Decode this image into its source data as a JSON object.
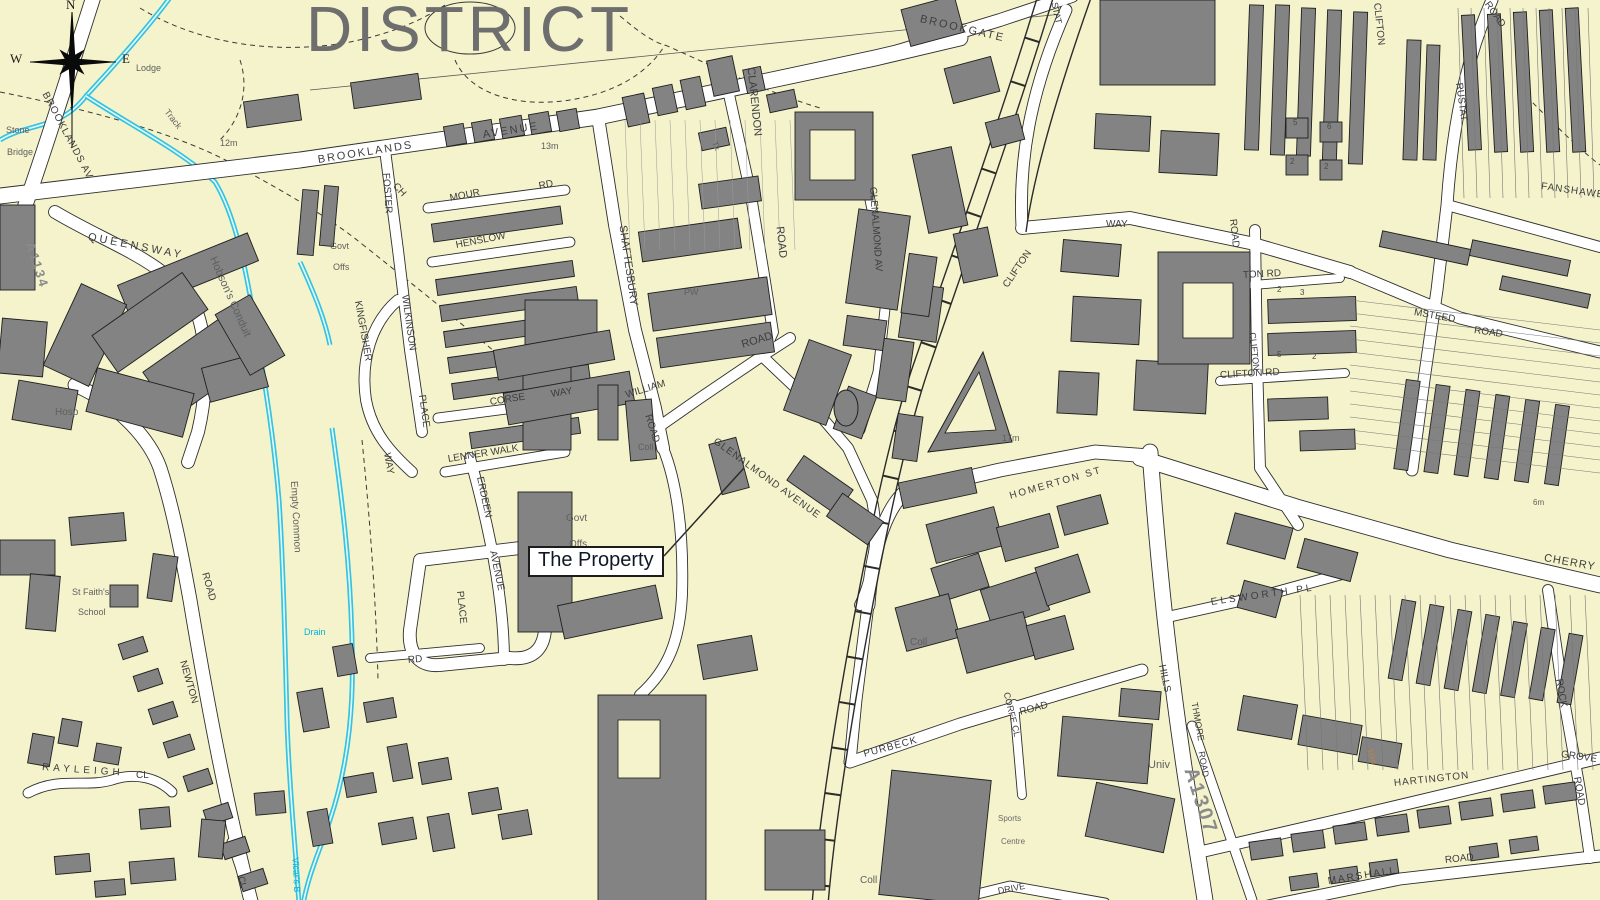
{
  "title": {
    "text": "DISTRICT"
  },
  "callout": {
    "text": "The Property"
  },
  "compass": {
    "north": "N",
    "west": "W",
    "east": "E"
  },
  "colors": {
    "background": "#f4f3cb",
    "building": "#838383",
    "road_fill": "#ffffff",
    "road_casing": "#2e2e2e",
    "water": "#35c3e0",
    "water_label": "#00b3d6",
    "contour_label": "#c08448",
    "title_gray": "#6e6e6e"
  },
  "map": {
    "labels": [
      {
        "t": "BROOKLANDS",
        "x": 318,
        "y": 155,
        "r": -9,
        "s": 11,
        "c": "road",
        "ls": 2
      },
      {
        "t": "AVENUE",
        "x": 483,
        "y": 130,
        "r": -9,
        "s": 11,
        "c": "road",
        "ls": 2
      },
      {
        "t": "BROOKLANDS AV",
        "x": 44,
        "y": 88,
        "r": 62,
        "s": 10,
        "c": "road",
        "ls": 1
      },
      {
        "t": "Stone",
        "x": 6,
        "y": 126,
        "r": 0,
        "s": 9,
        "c": "area"
      },
      {
        "t": "Bridge",
        "x": 7,
        "y": 148,
        "r": 0,
        "s": 9,
        "c": "area"
      },
      {
        "t": "Lodge",
        "x": 136,
        "y": 64,
        "r": 0,
        "s": 9,
        "c": "area"
      },
      {
        "t": "Track",
        "x": 166,
        "y": 106,
        "r": 52,
        "s": 9,
        "c": "area"
      },
      {
        "t": "12m",
        "x": 220,
        "y": 139,
        "r": 0,
        "s": 9,
        "c": "area"
      },
      {
        "t": "13m",
        "x": 541,
        "y": 142,
        "r": 0,
        "s": 9,
        "c": "area"
      },
      {
        "t": "Tk",
        "x": 714,
        "y": 138,
        "r": 70,
        "s": 8,
        "c": "area"
      },
      {
        "t": "QUEENSWAY",
        "x": 88,
        "y": 232,
        "r": 11,
        "s": 11,
        "c": "road",
        "ls": 3
      },
      {
        "t": "A1134",
        "x": 30,
        "y": 236,
        "r": 72,
        "s": 13,
        "c": "anum"
      },
      {
        "t": "Hobson's Conduit",
        "x": 212,
        "y": 252,
        "r": 66,
        "s": 11,
        "c": "area"
      },
      {
        "t": "Govt",
        "x": 330,
        "y": 242,
        "r": 0,
        "s": 9,
        "c": "area"
      },
      {
        "t": "Offs",
        "x": 333,
        "y": 263,
        "r": 0,
        "s": 9,
        "c": "area"
      },
      {
        "t": "FOSTER",
        "x": 385,
        "y": 168,
        "r": 86,
        "s": 10,
        "c": "road"
      },
      {
        "t": "CH",
        "x": 394,
        "y": 180,
        "r": 48,
        "s": 10,
        "c": "road"
      },
      {
        "t": "MOUR",
        "x": 450,
        "y": 194,
        "r": -11,
        "s": 10,
        "c": "road"
      },
      {
        "t": "RD",
        "x": 539,
        "y": 182,
        "r": -11,
        "s": 10,
        "c": "road"
      },
      {
        "t": "HENSLOW",
        "x": 456,
        "y": 241,
        "r": -11,
        "s": 10,
        "c": "road"
      },
      {
        "t": "KINGFISHER",
        "x": 357,
        "y": 296,
        "r": 80,
        "s": 10,
        "c": "road"
      },
      {
        "t": "WAY",
        "x": 386,
        "y": 448,
        "r": 80,
        "s": 10,
        "c": "road"
      },
      {
        "t": "WILKINSON",
        "x": 404,
        "y": 290,
        "r": 82,
        "s": 10,
        "c": "road"
      },
      {
        "t": "PLACE",
        "x": 421,
        "y": 390,
        "r": 82,
        "s": 10,
        "c": "road"
      },
      {
        "t": "CORSE",
        "x": 490,
        "y": 398,
        "r": -9,
        "s": 10,
        "c": "road"
      },
      {
        "t": "WAY",
        "x": 551,
        "y": 390,
        "r": -9,
        "s": 10,
        "c": "road"
      },
      {
        "t": "LENNER WALK",
        "x": 448,
        "y": 455,
        "r": -9,
        "s": 10,
        "c": "road"
      },
      {
        "t": "ERDEEN",
        "x": 479,
        "y": 472,
        "r": 78,
        "s": 10,
        "c": "road"
      },
      {
        "t": "AVENUE",
        "x": 492,
        "y": 546,
        "r": 78,
        "s": 10,
        "c": "road"
      },
      {
        "t": "PLACE",
        "x": 459,
        "y": 586,
        "r": 84,
        "s": 10,
        "c": "road"
      },
      {
        "t": "RD",
        "x": 408,
        "y": 656,
        "r": -5,
        "s": 10,
        "c": "road"
      },
      {
        "t": "SHAFTESBURY",
        "x": 622,
        "y": 220,
        "r": 82,
        "s": 11,
        "c": "road"
      },
      {
        "t": "CLARENDON",
        "x": 750,
        "y": 62,
        "r": 84,
        "s": 11,
        "c": "road"
      },
      {
        "t": "ROAD",
        "x": 779,
        "y": 221,
        "r": 84,
        "s": 11,
        "c": "road"
      },
      {
        "t": "PW",
        "x": 684,
        "y": 288,
        "r": 0,
        "s": 9,
        "c": "area"
      },
      {
        "t": "Coll",
        "x": 638,
        "y": 443,
        "r": 0,
        "s": 9,
        "c": "area"
      },
      {
        "t": "WILLIAM",
        "x": 626,
        "y": 391,
        "r": -17,
        "s": 10,
        "c": "road"
      },
      {
        "t": "ROAD",
        "x": 647,
        "y": 410,
        "r": 72,
        "s": 10,
        "c": "road"
      },
      {
        "t": "ROAD",
        "x": 742,
        "y": 340,
        "r": -17,
        "s": 11,
        "c": "road"
      },
      {
        "t": "GLENALMOND AV",
        "x": 872,
        "y": 182,
        "r": 86,
        "s": 10,
        "c": "road"
      },
      {
        "t": "GLENALMOND AVENUE",
        "x": 714,
        "y": 436,
        "r": 36,
        "s": 10,
        "c": "road",
        "ls": 1
      },
      {
        "t": "Govt",
        "x": 566,
        "y": 514,
        "r": 0,
        "s": 10,
        "c": "area"
      },
      {
        "t": "Offs",
        "x": 569,
        "y": 540,
        "r": 0,
        "s": 10,
        "c": "area"
      },
      {
        "t": "BROOKGATE",
        "x": 920,
        "y": 14,
        "r": 13,
        "s": 11,
        "c": "road",
        "ls": 2
      },
      {
        "t": "STAT",
        "x": 1054,
        "y": -2,
        "r": 78,
        "s": 9,
        "c": "road"
      },
      {
        "t": "CLIFTON",
        "x": 1006,
        "y": 282,
        "r": -56,
        "s": 10,
        "c": "road"
      },
      {
        "t": "WAY",
        "x": 1106,
        "y": 220,
        "r": 0,
        "s": 10,
        "c": "road"
      },
      {
        "t": "17m",
        "x": 1002,
        "y": 434,
        "r": 0,
        "s": 9,
        "c": "area"
      },
      {
        "t": "HOMERTON ST",
        "x": 1010,
        "y": 492,
        "r": -16,
        "s": 10,
        "c": "road",
        "ls": 2
      },
      {
        "t": "Coll",
        "x": 910,
        "y": 638,
        "r": 0,
        "s": 10,
        "c": "area"
      },
      {
        "t": "Coll",
        "x": 860,
        "y": 876,
        "r": 0,
        "s": 10,
        "c": "area"
      },
      {
        "t": "PURBECK",
        "x": 864,
        "y": 750,
        "r": -15,
        "s": 10,
        "c": "road",
        "ls": 1
      },
      {
        "t": "ROAD",
        "x": 1020,
        "y": 708,
        "r": -15,
        "s": 10,
        "c": "road"
      },
      {
        "t": "CORFE CL",
        "x": 1006,
        "y": 688,
        "r": 76,
        "s": 9,
        "c": "road"
      },
      {
        "t": "Sports",
        "x": 998,
        "y": 815,
        "r": 0,
        "s": 8,
        "c": "tiny"
      },
      {
        "t": "Centre",
        "x": 1001,
        "y": 838,
        "r": 0,
        "s": 8,
        "c": "tiny"
      },
      {
        "t": "Univ",
        "x": 1148,
        "y": 760,
        "r": 0,
        "s": 11,
        "c": "area"
      },
      {
        "t": "HILLS",
        "x": 1161,
        "y": 660,
        "r": 78,
        "s": 10,
        "c": "road"
      },
      {
        "t": "THMORE",
        "x": 1194,
        "y": 698,
        "r": 80,
        "s": 9,
        "c": "road"
      },
      {
        "t": "ROAD",
        "x": 1201,
        "y": 747,
        "r": 80,
        "s": 9,
        "c": "road"
      },
      {
        "t": "A1307",
        "x": 1190,
        "y": 758,
        "r": 72,
        "s": 20,
        "c": "anum"
      },
      {
        "t": "ELSWORTH PL",
        "x": 1211,
        "y": 598,
        "r": -8,
        "s": 10,
        "c": "road",
        "ls": 3
      },
      {
        "t": "CHERRY",
        "x": 1544,
        "y": 553,
        "r": 10,
        "s": 11,
        "c": "road",
        "ls": 1
      },
      {
        "t": "MSTEED",
        "x": 1414,
        "y": 308,
        "r": 10,
        "s": 10,
        "c": "road"
      },
      {
        "t": "ROAD",
        "x": 1474,
        "y": 326,
        "r": 8,
        "s": 10,
        "c": "road"
      },
      {
        "t": "FANSHAWE",
        "x": 1541,
        "y": 182,
        "r": 8,
        "s": 10,
        "c": "road",
        "ls": 1
      },
      {
        "t": "RUSTAT",
        "x": 1458,
        "y": 78,
        "r": 82,
        "s": 10,
        "c": "road"
      },
      {
        "t": "ROAD",
        "x": 1486,
        "y": -2,
        "r": 55,
        "s": 10,
        "c": "road"
      },
      {
        "t": "CLIFTON",
        "x": 1376,
        "y": -2,
        "r": 84,
        "s": 10,
        "c": "road"
      },
      {
        "t": "ROAD",
        "x": 1232,
        "y": 214,
        "r": 84,
        "s": 10,
        "c": "road"
      },
      {
        "t": "TON RD",
        "x": 1243,
        "y": 271,
        "r": -3,
        "s": 10,
        "c": "road"
      },
      {
        "t": "CLIFTON",
        "x": 1252,
        "y": 328,
        "r": 84,
        "s": 9,
        "c": "road"
      },
      {
        "t": "CLIFTON RD",
        "x": 1220,
        "y": 371,
        "r": -3,
        "s": 10,
        "c": "road"
      },
      {
        "t": "5",
        "x": 1293,
        "y": 119,
        "r": 0,
        "s": 8,
        "c": "num"
      },
      {
        "t": "6",
        "x": 1327,
        "y": 123,
        "r": 0,
        "s": 8,
        "c": "num"
      },
      {
        "t": "2",
        "x": 1290,
        "y": 158,
        "r": 0,
        "s": 8,
        "c": "num"
      },
      {
        "t": "2",
        "x": 1324,
        "y": 163,
        "r": 0,
        "s": 8,
        "c": "num"
      },
      {
        "t": "2",
        "x": 1277,
        "y": 286,
        "r": 0,
        "s": 8,
        "c": "num"
      },
      {
        "t": "3",
        "x": 1300,
        "y": 289,
        "r": 0,
        "s": 8,
        "c": "num"
      },
      {
        "t": "5",
        "x": 1277,
        "y": 351,
        "r": 0,
        "s": 8,
        "c": "num"
      },
      {
        "t": "2",
        "x": 1312,
        "y": 353,
        "r": 0,
        "s": 8,
        "c": "num"
      },
      {
        "t": "6m",
        "x": 1533,
        "y": 499,
        "r": 0,
        "s": 8,
        "c": "area"
      },
      {
        "t": "16m",
        "x": 1369,
        "y": 745,
        "r": 72,
        "s": 8,
        "c": "contour"
      },
      {
        "t": "ROCK",
        "x": 1558,
        "y": 674,
        "r": 80,
        "s": 10,
        "c": "road"
      },
      {
        "t": "GROVE",
        "x": 1561,
        "y": 750,
        "r": 8,
        "s": 10,
        "c": "road"
      },
      {
        "t": "ROAD",
        "x": 1576,
        "y": 772,
        "r": 80,
        "s": 10,
        "c": "road"
      },
      {
        "t": "HARTINGTON",
        "x": 1394,
        "y": 779,
        "r": -6,
        "s": 10,
        "c": "road",
        "ls": 1
      },
      {
        "t": "MARSHALL",
        "x": 1328,
        "y": 877,
        "r": -9,
        "s": 10,
        "c": "road",
        "ls": 2
      },
      {
        "t": "ROAD",
        "x": 1445,
        "y": 856,
        "r": -6,
        "s": 10,
        "c": "road"
      },
      {
        "t": "DRIVE",
        "x": 998,
        "y": 887,
        "r": -11,
        "s": 9,
        "c": "road"
      },
      {
        "t": "NEWTON",
        "x": 182,
        "y": 656,
        "r": 74,
        "s": 10,
        "c": "road"
      },
      {
        "t": "ROAD",
        "x": 204,
        "y": 568,
        "r": 74,
        "s": 10,
        "c": "road"
      },
      {
        "t": "St Faith's",
        "x": 72,
        "y": 588,
        "r": 0,
        "s": 9,
        "c": "area"
      },
      {
        "t": "School",
        "x": 78,
        "y": 608,
        "r": 0,
        "s": 9,
        "c": "area"
      },
      {
        "t": "Empty Common",
        "x": 293,
        "y": 476,
        "r": 87,
        "s": 10,
        "c": "area"
      },
      {
        "t": "Drain",
        "x": 304,
        "y": 628,
        "r": 0,
        "s": 9,
        "c": "water"
      },
      {
        "t": "Vicar's B",
        "x": 295,
        "y": 853,
        "r": 87,
        "s": 9,
        "c": "water"
      },
      {
        "t": "RAYLEIGH",
        "x": 42,
        "y": 763,
        "r": 4,
        "s": 10,
        "c": "road",
        "ls": 4
      },
      {
        "t": "CL",
        "x": 136,
        "y": 771,
        "r": 0,
        "s": 10,
        "c": "road"
      },
      {
        "t": "CL",
        "x": 241,
        "y": 872,
        "r": 78,
        "s": 9,
        "c": "road"
      },
      {
        "t": "Hosp",
        "x": 55,
        "y": 408,
        "r": 0,
        "s": 10,
        "c": "area"
      }
    ]
  }
}
